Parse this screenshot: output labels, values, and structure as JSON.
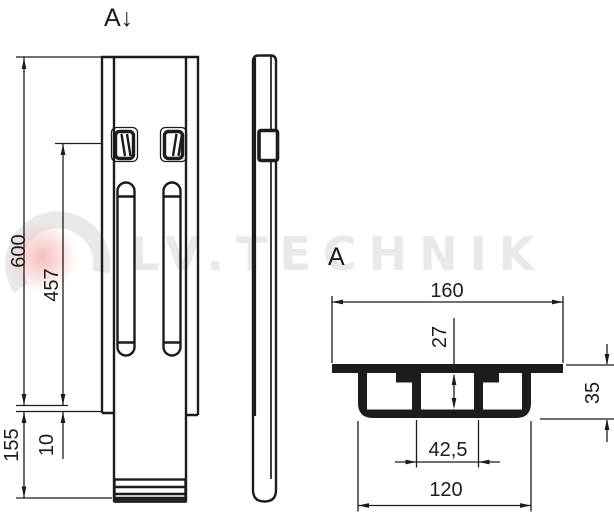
{
  "page": {
    "background": "#ffffff",
    "line_color": "#1c1c1c"
  },
  "labels": {
    "cut_mark": "A↓",
    "section_view": "A"
  },
  "front_dims": {
    "total_length": "600",
    "slot_center": "457",
    "bottom_section": "155",
    "step_offset": "10"
  },
  "section_dims": {
    "flange_width": "160",
    "cell_inner_height": "27",
    "profile_depth": "35",
    "center_cell_width": "42,5",
    "channel_width": "120"
  },
  "watermark": {
    "brand": "LV.TECHNIK",
    "gray": "#e9e9e9",
    "pink": "#f5bcba"
  }
}
